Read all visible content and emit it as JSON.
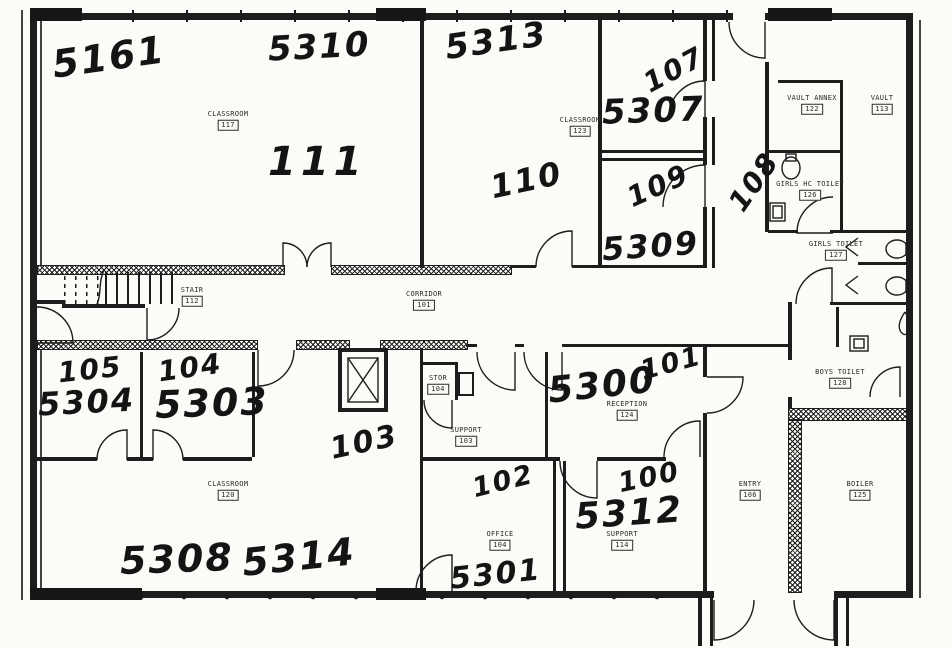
{
  "colors": {
    "ink": "#1d1d1d",
    "paper": "#fbfbf8"
  },
  "hw": {
    "5161": "5161",
    "5310": "5310",
    "5313": "5313",
    "111": "111",
    "110": "110",
    "107": "107",
    "5307": "5307",
    "109": "109",
    "5309": "5309",
    "108": "108",
    "105": "105",
    "5304": "5304",
    "104": "104",
    "5303": "5303",
    "103": "103",
    "5308": "5308",
    "5314": "5314",
    "102": "102",
    "5301": "5301",
    "100": "100",
    "5312": "5312",
    "5300": "5300",
    "101": "101"
  },
  "printed": {
    "classroom_nw": {
      "label": "CLASSROOM",
      "num": "117"
    },
    "classroom_n": {
      "label": "CLASSROOM",
      "num": "123"
    },
    "vault_annex": {
      "label": "VAULT ANNEX",
      "num": "122"
    },
    "vault": {
      "label": "VAULT",
      "num": "113"
    },
    "girls_hc": {
      "label": "GIRLS HC TOILET",
      "num": "126"
    },
    "girls_toilet": {
      "label": "GIRLS TOILET",
      "num": "127"
    },
    "boys_toilet": {
      "label": "BOYS TOILET",
      "num": "128"
    },
    "stair": {
      "label": "STAIR",
      "num": "112"
    },
    "corridor": {
      "label": "CORRIDOR",
      "num": "101"
    },
    "classroom_sw": {
      "label": "CLASSROOM",
      "num": "120"
    },
    "stor": {
      "label": "STOR",
      "num": "104"
    },
    "support_mid": {
      "label": "SUPPORT",
      "num": "103"
    },
    "reception": {
      "label": "RECEPTION",
      "num": "124"
    },
    "office": {
      "label": "OFFICE",
      "num": "104"
    },
    "support_se": {
      "label": "SUPPORT",
      "num": "114"
    },
    "entry": {
      "label": "ENTRY",
      "num": "106"
    },
    "boiler": {
      "label": "BOILER",
      "num": "125"
    }
  },
  "fixtures": [
    "stairs",
    "elevator",
    "toilet",
    "sink",
    "door-swing",
    "light"
  ]
}
